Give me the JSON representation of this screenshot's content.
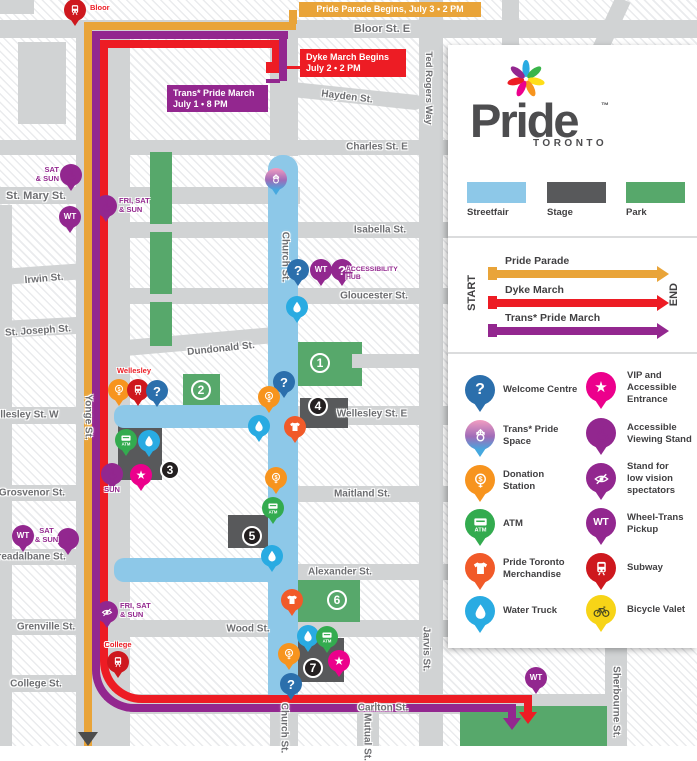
{
  "colors": {
    "street": "#D1D3D4",
    "streetfair": "#8DC8E8",
    "stage": "#58595B",
    "park": "#57A86B",
    "parade": "#E9A439",
    "dyke": "#ED1C24",
    "trans": "#93278F",
    "marker_park": "#57A86B",
    "marker_stage": "#231F20",
    "pins": {
      "welcome": "#2B6FAC",
      "trans": "gradient",
      "donation": "#F7941E",
      "atm": "#33AB4F",
      "merch": "#F15A29",
      "water": "#29ABE2",
      "vip": "#EC008C",
      "accessible": "#92278F",
      "lowvision": "#92278F",
      "wt": "#92278F",
      "hub": "#92278F",
      "subway": "#CE181E",
      "bike": "#F7D417"
    }
  },
  "map": {
    "streets": [
      {
        "n": "block-northwest",
        "x": 0,
        "y": 0,
        "w": 34,
        "h": 14
      },
      {
        "n": "block-bloor-yonge",
        "x": 18,
        "y": 42,
        "w": 48,
        "h": 82
      },
      {
        "n": "bloor-st-e",
        "x": 0,
        "y": 20,
        "w": 697,
        "h": 18
      },
      {
        "n": "hayden-st",
        "x": 274,
        "y": 80,
        "w": 150,
        "h": 15,
        "rot": 6,
        "rad": "8px"
      },
      {
        "n": "charles-st-e",
        "x": 0,
        "y": 140,
        "w": 455,
        "h": 15
      },
      {
        "n": "st-mary-st",
        "x": 0,
        "y": 187,
        "w": 300,
        "h": 17
      },
      {
        "n": "isabella-st",
        "x": 114,
        "y": 222,
        "w": 341,
        "h": 16
      },
      {
        "n": "irwin-st",
        "x": 0,
        "y": 269,
        "w": 114,
        "h": 16,
        "rot": -4
      },
      {
        "n": "gloucester-st",
        "x": 114,
        "y": 288,
        "w": 341,
        "h": 16
      },
      {
        "n": "st-joseph-st",
        "x": 0,
        "y": 321,
        "w": 114,
        "h": 17,
        "rot": -3
      },
      {
        "n": "dundonald-st",
        "x": 114,
        "y": 341,
        "w": 168,
        "h": 16,
        "rot": -5,
        "rad": "6px"
      },
      {
        "n": "wellesley-st-w",
        "x": 0,
        "y": 407,
        "w": 78,
        "h": 17
      },
      {
        "n": "wellesley-st-e",
        "x": 298,
        "y": 406,
        "w": 157,
        "h": 19
      },
      {
        "n": "grosvenor-st",
        "x": 0,
        "y": 485,
        "w": 100,
        "h": 16
      },
      {
        "n": "maitland-st",
        "x": 298,
        "y": 486,
        "w": 157,
        "h": 16
      },
      {
        "n": "breadalbane-st",
        "x": 0,
        "y": 549,
        "w": 114,
        "h": 16
      },
      {
        "n": "alexander-st",
        "x": 298,
        "y": 564,
        "w": 157,
        "h": 16
      },
      {
        "n": "grenville-st",
        "x": 0,
        "y": 619,
        "w": 114,
        "h": 16
      },
      {
        "n": "wood-st",
        "x": 104,
        "y": 620,
        "w": 351,
        "h": 17
      },
      {
        "n": "college-st",
        "x": 0,
        "y": 675,
        "w": 80,
        "h": 17
      },
      {
        "n": "carlton-st",
        "x": 104,
        "y": 694,
        "w": 503,
        "h": 20
      },
      {
        "n": "bay-st",
        "x": 0,
        "y": 205,
        "w": 12,
        "h": 541
      },
      {
        "n": "yonge-st",
        "x": 76,
        "y": 38,
        "w": 54,
        "h": 708
      },
      {
        "n": "church-st-north",
        "x": 270,
        "y": 38,
        "w": 28,
        "h": 118
      },
      {
        "n": "church-st-south",
        "x": 270,
        "y": 700,
        "w": 28,
        "h": 46
      },
      {
        "n": "ted-rogers-jarvis",
        "x": 419,
        "y": 0,
        "w": 24,
        "h": 746
      },
      {
        "n": "mutual-st",
        "x": 357,
        "y": 714,
        "w": 22,
        "h": 32
      },
      {
        "n": "sherbourne-st",
        "x": 605,
        "y": 640,
        "w": 22,
        "h": 106
      },
      {
        "n": "top-street-1",
        "x": 502,
        "y": 0,
        "w": 17,
        "h": 46
      },
      {
        "n": "top-street-diagonal",
        "x": 616,
        "y": -4,
        "w": 16,
        "h": 60,
        "rot": 25
      }
    ],
    "zones": [
      {
        "k": "park",
        "x": 150,
        "y": 152,
        "w": 22,
        "h": 72
      },
      {
        "k": "park",
        "x": 150,
        "y": 232,
        "w": 22,
        "h": 62
      },
      {
        "k": "park",
        "x": 150,
        "y": 302,
        "w": 22,
        "h": 44
      },
      {
        "k": "park",
        "x": 296,
        "y": 342,
        "w": 66,
        "h": 44
      },
      {
        "k": "park",
        "x": 183,
        "y": 374,
        "w": 37,
        "h": 33
      },
      {
        "k": "park",
        "x": 295,
        "y": 580,
        "w": 65,
        "h": 42
      },
      {
        "k": "park",
        "x": 460,
        "y": 706,
        "w": 147,
        "h": 40
      },
      {
        "k": "street",
        "x": 352,
        "y": 354,
        "w": 68,
        "h": 14
      },
      {
        "k": "stage",
        "x": 118,
        "y": 423,
        "w": 44,
        "h": 57
      },
      {
        "k": "stage",
        "x": 300,
        "y": 398,
        "w": 48,
        "h": 30
      },
      {
        "k": "stage",
        "x": 228,
        "y": 515,
        "w": 52,
        "h": 33
      },
      {
        "k": "stage",
        "x": 296,
        "y": 638,
        "w": 48,
        "h": 44
      },
      {
        "k": "streetfair",
        "x": 268,
        "y": 155,
        "w": 30,
        "h": 545,
        "rad": "14px 14px 0 0"
      },
      {
        "k": "streetfair",
        "x": 114,
        "y": 405,
        "w": 184,
        "h": 23,
        "rad": "10px 0 0 10px"
      },
      {
        "k": "streetfair",
        "x": 114,
        "y": 558,
        "w": 154,
        "h": 24,
        "rad": "10px 0 0 10px"
      }
    ],
    "labels": [
      {
        "t": "Bloor St. E",
        "x": 382,
        "y": 29,
        "fs": 11
      },
      {
        "t": "Hayden St.",
        "x": 347,
        "y": 97,
        "rot": 7
      },
      {
        "t": "Charles St. E",
        "x": 377,
        "y": 147
      },
      {
        "t": "St. Mary St.",
        "x": 36,
        "y": 196,
        "fs": 11
      },
      {
        "t": "Isabella St.",
        "x": 380,
        "y": 230
      },
      {
        "t": "Irwin St.",
        "x": 44,
        "y": 279,
        "rot": -5
      },
      {
        "t": "Gloucester St.",
        "x": 374,
        "y": 296
      },
      {
        "t": "St. Joseph St.",
        "x": 38,
        "y": 331,
        "rot": -4
      },
      {
        "t": "Dundonald St.",
        "x": 221,
        "y": 349,
        "rot": -6
      },
      {
        "t": "Wellesley St. E",
        "x": 372,
        "y": 414
      },
      {
        "t": "Wellesley St. W",
        "x": 22,
        "y": 415
      },
      {
        "t": "Grosvenor St.",
        "x": 32,
        "y": 493
      },
      {
        "t": "Maitland St.",
        "x": 362,
        "y": 494
      },
      {
        "t": "Breadalbane St.",
        "x": 28,
        "y": 557
      },
      {
        "t": "Alexander St.",
        "x": 340,
        "y": 572
      },
      {
        "t": "Grenville St.",
        "x": 46,
        "y": 627
      },
      {
        "t": "Wood St.",
        "x": 248,
        "y": 629
      },
      {
        "t": "College St.",
        "x": 36,
        "y": 684
      },
      {
        "t": "Carlton St.",
        "x": 383,
        "y": 708
      },
      {
        "t": "Yonge St.",
        "x": 88,
        "y": 417,
        "v": 1
      },
      {
        "t": "Church St.",
        "x": 285,
        "y": 257,
        "v": 1
      },
      {
        "t": "Church St.",
        "x": 284,
        "y": 728,
        "v": 1
      },
      {
        "t": "Ted Rogers Way",
        "x": 428,
        "y": 88,
        "v": 1,
        "fs": 9.5
      },
      {
        "t": "Jarvis St.",
        "x": 426,
        "y": 649,
        "v": 1
      },
      {
        "t": "Mutual St.",
        "x": 367,
        "y": 737,
        "v": 1
      },
      {
        "t": "Sherbourne St.",
        "x": 616,
        "y": 702,
        "v": 1
      }
    ],
    "routes": [
      {
        "n": "pride-parade",
        "c": "parade",
        "segs": [
          [
            84,
            22,
            212,
            8
          ],
          [
            289,
            10,
            8,
            14
          ],
          [
            84,
            22,
            8,
            724
          ]
        ]
      },
      {
        "n": "dyke-march",
        "c": "dyke",
        "segs": [
          [
            100,
            40,
            180,
            8
          ],
          [
            272,
            42,
            8,
            22
          ],
          [
            266,
            62,
            16,
            11
          ],
          [
            282,
            66,
            18,
            3
          ],
          [
            100,
            40,
            8,
            597
          ],
          [
            146,
            695,
            386,
            8
          ],
          [
            524,
            695,
            8,
            18
          ]
        ],
        "elbow": [
          100,
          629,
          58,
          74
        ],
        "arrow": [
          519,
          712
        ]
      },
      {
        "n": "trans-pride-march",
        "c": "trans",
        "segs": [
          [
            92,
            31,
            196,
            8
          ],
          [
            279,
            31,
            8,
            50
          ],
          [
            266,
            79,
            14,
            4
          ],
          [
            92,
            31,
            8,
            614
          ],
          [
            136,
            704,
            380,
            8
          ],
          [
            508,
            704,
            8,
            15
          ]
        ],
        "elbow": [
          92,
          637,
          56,
          75
        ],
        "arrow": [
          503,
          718
        ]
      }
    ],
    "pins": [
      {
        "k": "subway",
        "x": 64,
        "y": -1
      },
      {
        "k": "accessible",
        "x": 60,
        "y": 164
      },
      {
        "k": "wt",
        "x": 59,
        "y": 206
      },
      {
        "k": "accessible",
        "x": 95,
        "y": 195
      },
      {
        "k": "trans",
        "x": 265,
        "y": 168
      },
      {
        "k": "welcome",
        "x": 287,
        "y": 259
      },
      {
        "k": "wt",
        "x": 310,
        "y": 259
      },
      {
        "k": "hub",
        "x": 331,
        "y": 259
      },
      {
        "k": "water",
        "x": 286,
        "y": 296
      },
      {
        "k": "donation",
        "x": 108,
        "y": 379
      },
      {
        "k": "subway",
        "x": 127,
        "y": 379
      },
      {
        "k": "welcome",
        "x": 146,
        "y": 380
      },
      {
        "k": "welcome",
        "x": 273,
        "y": 371
      },
      {
        "k": "donation",
        "x": 258,
        "y": 386
      },
      {
        "k": "water",
        "x": 248,
        "y": 415
      },
      {
        "k": "merch",
        "x": 284,
        "y": 416
      },
      {
        "k": "atm",
        "x": 115,
        "y": 429
      },
      {
        "k": "water",
        "x": 138,
        "y": 430
      },
      {
        "k": "accessible",
        "x": 101,
        "y": 463
      },
      {
        "k": "vip",
        "x": 130,
        "y": 464
      },
      {
        "k": "donation",
        "x": 265,
        "y": 467
      },
      {
        "k": "atm",
        "x": 262,
        "y": 497
      },
      {
        "k": "water",
        "x": 261,
        "y": 545
      },
      {
        "k": "wt",
        "x": 12,
        "y": 525
      },
      {
        "k": "accessible",
        "x": 57,
        "y": 528
      },
      {
        "k": "merch",
        "x": 281,
        "y": 589
      },
      {
        "k": "lowvision",
        "x": 96,
        "y": 601
      },
      {
        "k": "water",
        "x": 297,
        "y": 625
      },
      {
        "k": "atm",
        "x": 316,
        "y": 626
      },
      {
        "k": "donation",
        "x": 278,
        "y": 643
      },
      {
        "k": "vip",
        "x": 328,
        "y": 650
      },
      {
        "k": "welcome",
        "x": 280,
        "y": 673
      },
      {
        "k": "subway",
        "x": 107,
        "y": 651
      },
      {
        "k": "wt",
        "x": 525,
        "y": 667
      }
    ],
    "pin_labels": [
      {
        "t": "Bloor",
        "x": 90,
        "y": 4,
        "c": "dyke",
        "a": "l"
      },
      {
        "t": "Wellesley",
        "x": 114,
        "y": 367,
        "c": "dyke",
        "a": "c",
        "w": 40
      },
      {
        "t": "College",
        "x": 98,
        "y": 641,
        "c": "dyke",
        "a": "c",
        "w": 40
      },
      {
        "t": "SAT\n& SUN",
        "x": 26,
        "y": 166,
        "c": "trans",
        "a": "r",
        "w": 33
      },
      {
        "t": "FRI, SAT\n& SUN",
        "x": 119,
        "y": 197,
        "c": "trans",
        "a": "l"
      },
      {
        "t": "SUN",
        "x": 101,
        "y": 486,
        "c": "trans",
        "a": "c",
        "w": 22
      },
      {
        "t": "SAT\n& SUN",
        "x": 33,
        "y": 527,
        "c": "trans",
        "a": "c",
        "w": 27
      },
      {
        "t": "FRI, SAT\n& SUN",
        "x": 120,
        "y": 602,
        "c": "trans",
        "a": "l"
      },
      {
        "t": "ACCESSIBILITY\nHUB",
        "x": 346,
        "y": 266,
        "c": "trans",
        "a": "l",
        "fs": 6.8
      }
    ],
    "markers": [
      {
        "n": "1",
        "k": "park",
        "x": 320,
        "y": 363
      },
      {
        "n": "2",
        "k": "park",
        "x": 201,
        "y": 390
      },
      {
        "n": "3",
        "k": "stage",
        "x": 170,
        "y": 470
      },
      {
        "n": "4",
        "k": "stage",
        "x": 318,
        "y": 406
      },
      {
        "n": "5",
        "k": "stage",
        "x": 252,
        "y": 536
      },
      {
        "n": "6",
        "k": "park",
        "x": 337,
        "y": 600
      },
      {
        "n": "7",
        "k": "stage",
        "x": 313,
        "y": 668
      }
    ],
    "banners": [
      {
        "n": "pride-parade-begins",
        "c": "parade",
        "lines": [
          "Pride Parade Begins, July 3 • 2 PM"
        ],
        "x": 299,
        "y": 2,
        "w": 182,
        "h": 15,
        "a": "c"
      },
      {
        "n": "dyke-march-begins",
        "c": "dyke",
        "lines": [
          "Dyke March Begins",
          "July 2 • 2 PM"
        ],
        "x": 300,
        "y": 49,
        "w": 106,
        "h": 28,
        "a": "l"
      },
      {
        "n": "trans-pride-march-begins",
        "c": "trans",
        "lines": [
          "Trans* Pride March",
          "July 1 • 8 PM"
        ],
        "x": 167,
        "y": 85,
        "w": 101,
        "h": 27,
        "a": "l"
      }
    ],
    "hub_icon": {
      "x": 351,
      "y": 251
    },
    "end_arrow": {
      "x": 78,
      "y": 732,
      "c": "#4D4D4D"
    }
  },
  "panel": {
    "logo": {
      "title": "Pride",
      "tm": "™",
      "subtitle": "TORONTO",
      "petals": [
        "#29ABE2",
        "#39B54A",
        "#FFDE17",
        "#F7941E",
        "#EC008C",
        "#ED1C24",
        "#93278F"
      ]
    },
    "area_legend": {
      "y": 182,
      "items": [
        {
          "label": "Streetfair",
          "color": "#8DC8E8",
          "x": 467
        },
        {
          "label": "Stage",
          "color": "#58595B",
          "x": 547
        },
        {
          "label": "Park",
          "color": "#57A86B",
          "x": 626
        }
      ]
    },
    "marches": {
      "start": "START",
      "end": "END",
      "items": [
        {
          "label": "Pride Parade",
          "c": "parade",
          "y": 270
        },
        {
          "label": "Dyke March",
          "c": "dyke",
          "y": 299
        },
        {
          "label": "Trans* Pride March",
          "c": "trans",
          "y": 327
        }
      ]
    },
    "icon_legend": {
      "left": {
        "px": 465,
        "tx": 503,
        "rows": [
          {
            "k": "welcome",
            "label": "Welcome Centre",
            "y": 375
          },
          {
            "k": "trans",
            "label": "Trans* Pride\nSpace",
            "y": 420
          },
          {
            "k": "donation",
            "label": "Donation\nStation",
            "y": 465
          },
          {
            "k": "atm",
            "label": "ATM",
            "y": 509
          },
          {
            "k": "merch",
            "label": "Pride Toronto\nMerchandise",
            "y": 553
          },
          {
            "k": "water",
            "label": "Water Truck",
            "y": 596
          }
        ]
      },
      "right": {
        "px": 586,
        "tx": 627,
        "rows": [
          {
            "k": "vip",
            "label": "VIP and\nAccessible\nEntrance",
            "y": 372
          },
          {
            "k": "accessible",
            "label": "Accessible\nViewing Stand",
            "y": 418
          },
          {
            "k": "lowvision",
            "label": "Stand for\nlow vision\nspectators",
            "y": 463
          },
          {
            "k": "wt",
            "label": "Wheel-Trans\nPickup",
            "y": 508
          },
          {
            "k": "subway",
            "label": "Subway",
            "y": 553
          },
          {
            "k": "bike",
            "label": "Bicycle Valet",
            "y": 595
          }
        ]
      }
    }
  }
}
